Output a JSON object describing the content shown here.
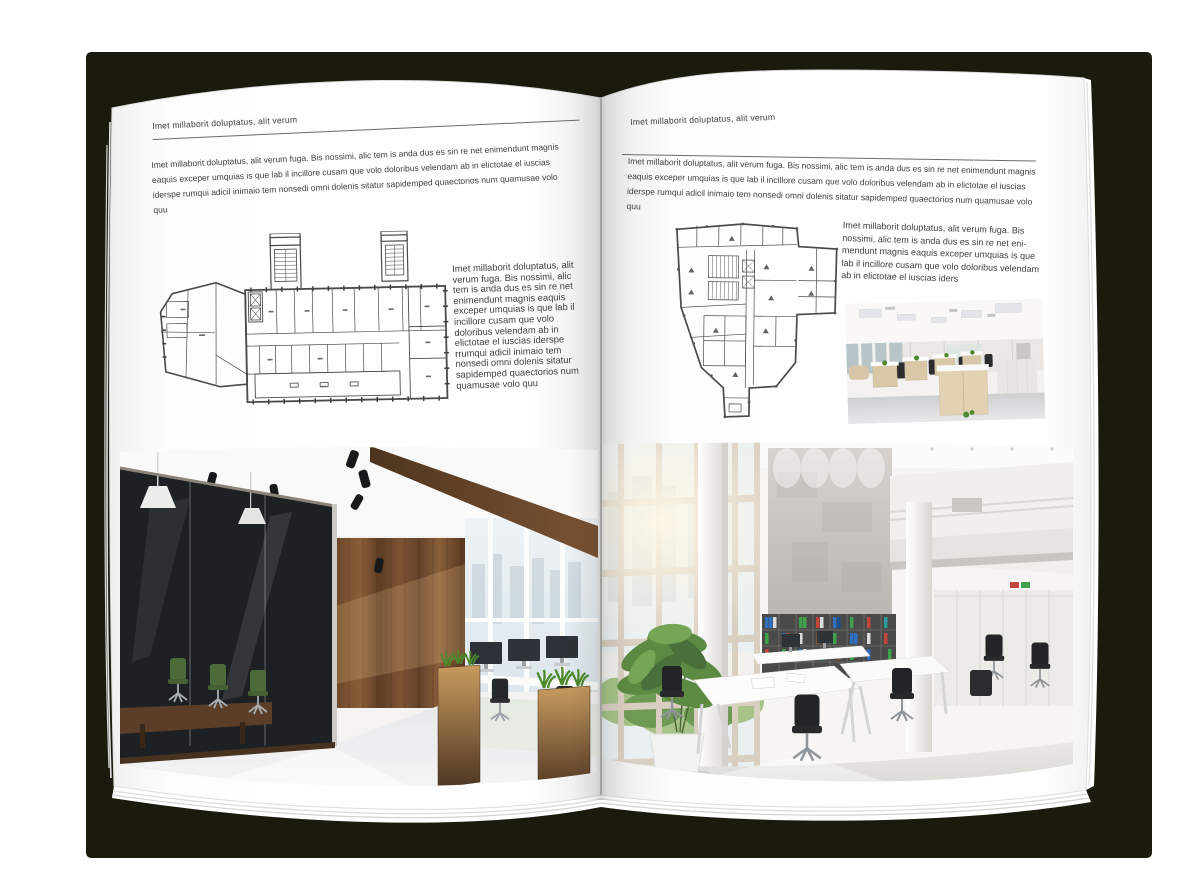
{
  "mockup": {
    "background_color": "#ffffff",
    "cover_color": "#1a1b0c",
    "page_color": "#ffffff",
    "text_color": "#3d3d3d",
    "rule_color": "#6b6b6b"
  },
  "left_page": {
    "header": "Imet millaborit doluptatus, alit verum",
    "intro": "Imet millaborit doluptatus, alit verum fuga. Bis nossimi, alic tem is anda dus es sin re net enimendunt magnis eaquis exceper umquias is que lab il incillore cusam que volo doloribus velendam ab in elictotae el iuscias iderspe rumqui adicil inimaio tem nonsedi omni dolenis sitatur sapidemped quaectorios num quamusae volo quu",
    "caption": "Imet millaborit doluptatus, alit verum fuga. Bis nossimi, alic tem is anda dus es sin re net enimendunt magnis eaquis exceper umquias is que lab il incillore cusam que volo doloribus velendam ab in elictotae el iuscias iderspe rrumqui adicil inimaio tem nonsedi omni dolenis sitatur sapidemped quaectorios num quamusae volo quu",
    "figures": {
      "floor_plan": "wide-building-floor-plan-with-two-stair-towers",
      "photo": "office-interior-with-glass-meeting-room-and-wood-wall"
    }
  },
  "right_page": {
    "header": "Imet millaborit doluptatus, alit verum",
    "intro": "Imet millaborit doluptatus, alit verum fuga. Bis nossimi, alic tem is anda dus es sin re net enimendunt magnis eaquis exceper umquias is que lab il incillore cusam que volo doloribus velendam ab in elictotae el iuscias iderspe rumqui adicil inimaio tem nonsedi omni dolenis sitatur sapidemped quaectorios num quamusae volo quu",
    "caption": "Imet millaborit doluptatus, alit verum fuga. Bis nossimi, alic tem is anda dus es sin re net eni-mendunt magnis eaquis exceper umquias is que lab il incillore cusam que volo doloribus velendam ab in elictotae el iuscias iders",
    "figures": {
      "floor_plan": "irregular-tower-floor-plan",
      "photo_small": "open-plan-office-with-desk-rows",
      "photo_large": "double-height-office-atrium-with-bookshelves"
    }
  }
}
